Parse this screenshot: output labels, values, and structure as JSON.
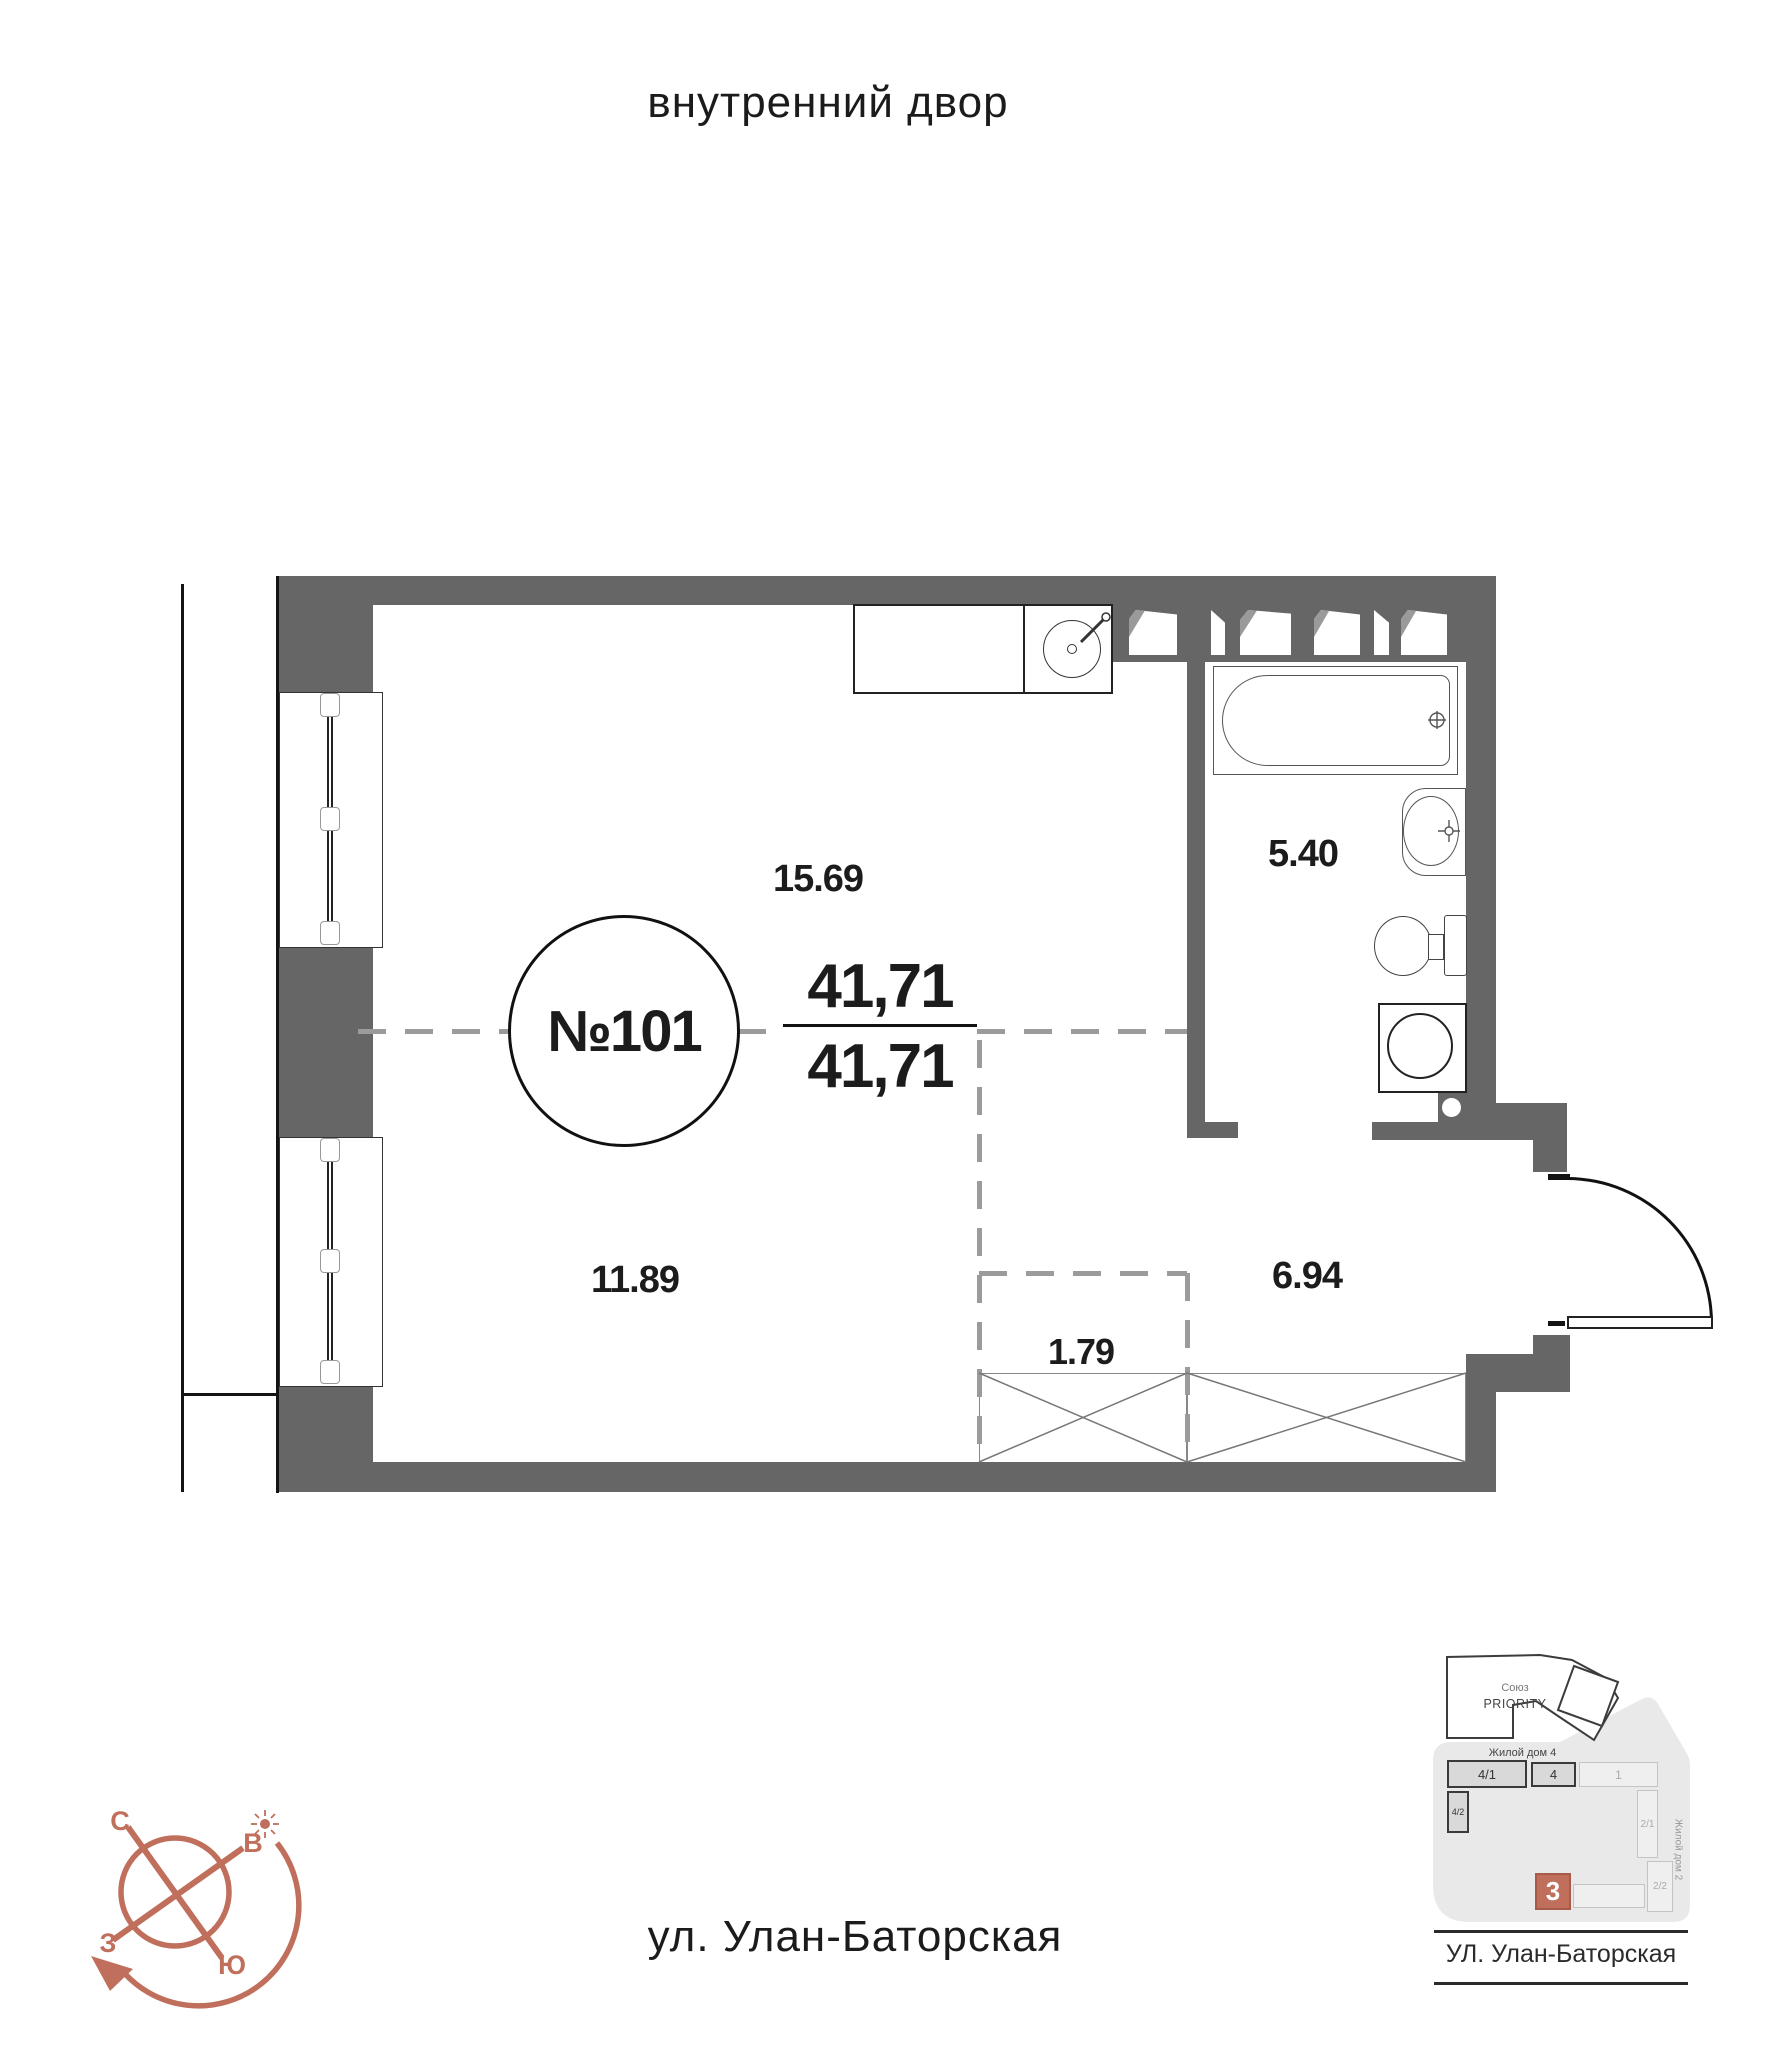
{
  "header": {
    "courtyard_label": "внутренний двор"
  },
  "footer": {
    "street_label": "ул. Улан-Баторская"
  },
  "apartment": {
    "number": "№101",
    "area_total": "41,71",
    "area_living": "41,71",
    "areas": {
      "kitchen_living": "15.69",
      "bathroom": "5.40",
      "room": "11.89",
      "hall": "6.94",
      "wardrobe": "1.79"
    }
  },
  "compass": {
    "north": "С",
    "east": "В",
    "west": "З",
    "south": "Ю"
  },
  "minimap": {
    "complex_line1": "Союз",
    "complex_line2": "PRIORITY",
    "house4_label": "Жилой дом 4",
    "house2_label": "Жилой дом 2",
    "current_building_number": "3",
    "street_label": "УЛ. Улан-Баторская",
    "buildings": [
      {
        "label": "4/1"
      },
      {
        "label": "4"
      },
      {
        "label": "1"
      },
      {
        "label": "4/2"
      },
      {
        "label": "2/1"
      },
      {
        "label": "2/2"
      }
    ]
  },
  "colors": {
    "wall": "#666666",
    "accent": "#bf6f5b",
    "dash": "#9b9b9b"
  }
}
